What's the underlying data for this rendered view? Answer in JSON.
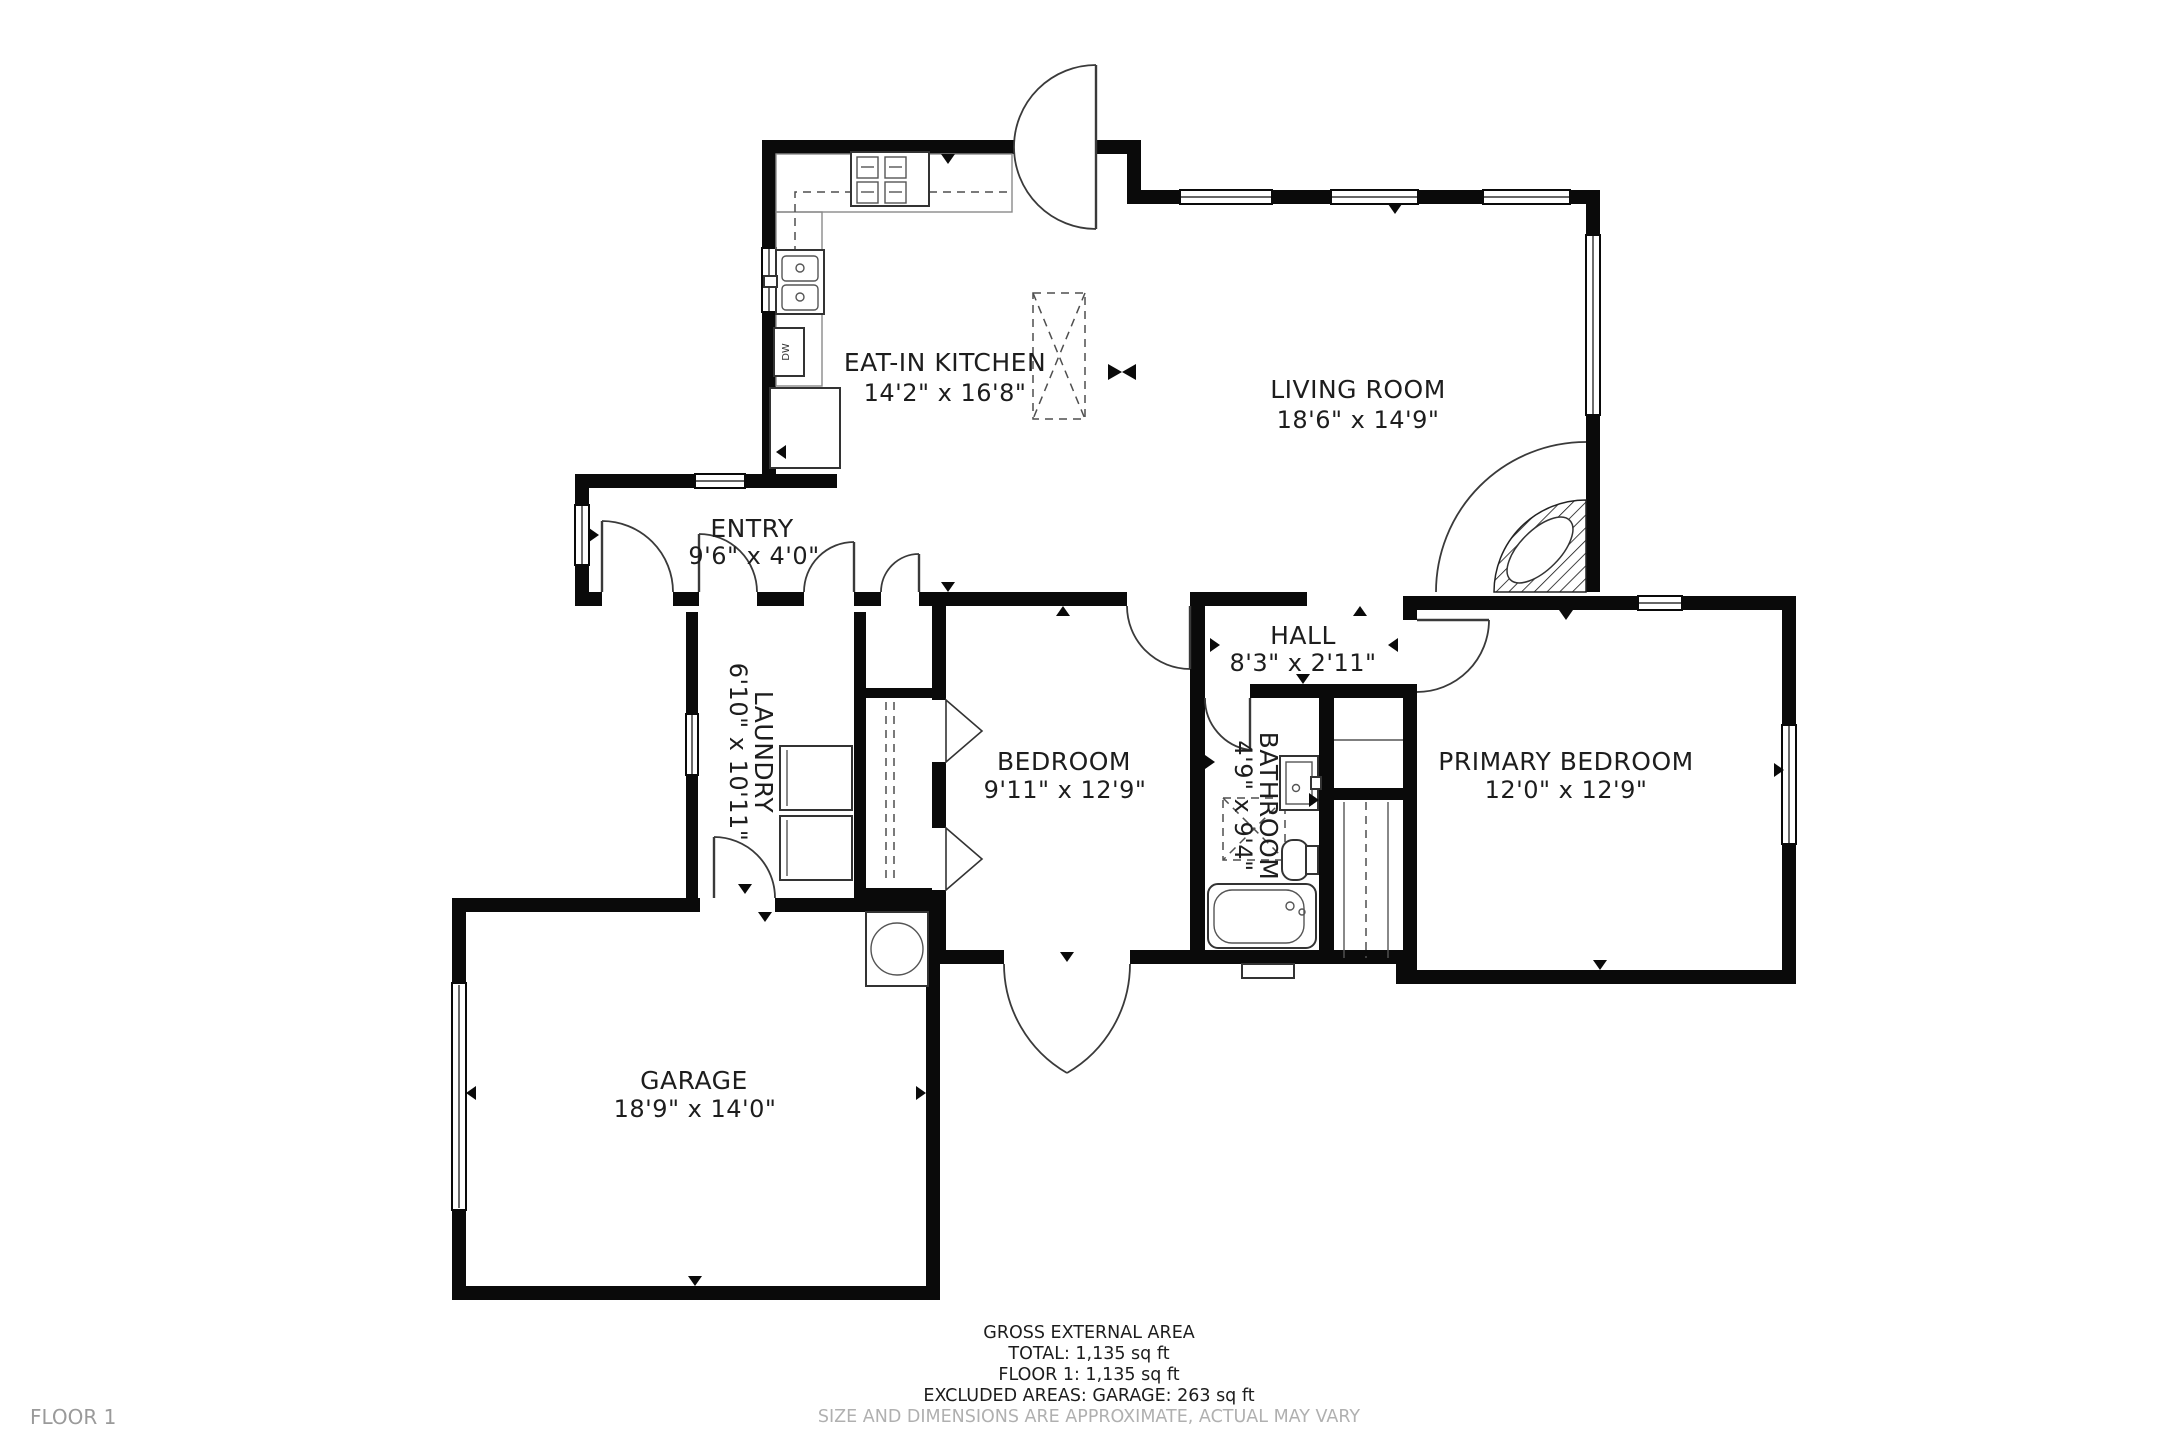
{
  "floor_tag": "FLOOR 1",
  "rooms": {
    "kitchen": {
      "name": "EAT-IN KITCHEN",
      "dims": "14'2\" x 16'8\""
    },
    "living": {
      "name": "LIVING ROOM",
      "dims": "18'6\" x 14'9\""
    },
    "entry": {
      "name": "ENTRY",
      "dims": "9'6\" x 4'0\""
    },
    "hall": {
      "name": "HALL",
      "dims": "8'3\" x 2'11\""
    },
    "laundry": {
      "name": "LAUNDRY",
      "dims": "6'10\" x 10'11\""
    },
    "bedroom": {
      "name": "BEDROOM",
      "dims": "9'11\" x 12'9\""
    },
    "bathroom": {
      "name": "BATHROOM",
      "dims": "4'9\" x 9'4\""
    },
    "primary": {
      "name": "PRIMARY BEDROOM",
      "dims": "12'0\" x 12'9\""
    },
    "garage": {
      "name": "GARAGE",
      "dims": "18'9\" x 14'0\""
    }
  },
  "appliances": {
    "dw_label": "DW"
  },
  "footer": {
    "title": "GROSS EXTERNAL AREA",
    "total": "TOTAL: 1,135 sq ft",
    "floor": "FLOOR 1: 1,135 sq ft",
    "excluded": "EXCLUDED AREAS: GARAGE: 263 sq ft",
    "disclaimer": "SIZE AND DIMENSIONS ARE APPROXIMATE, ACTUAL MAY VARY"
  },
  "colors": {
    "wall": "#0a0a0a",
    "text": "#1d1d1d",
    "muted": "#b0b0b0",
    "background": "#ffffff"
  }
}
